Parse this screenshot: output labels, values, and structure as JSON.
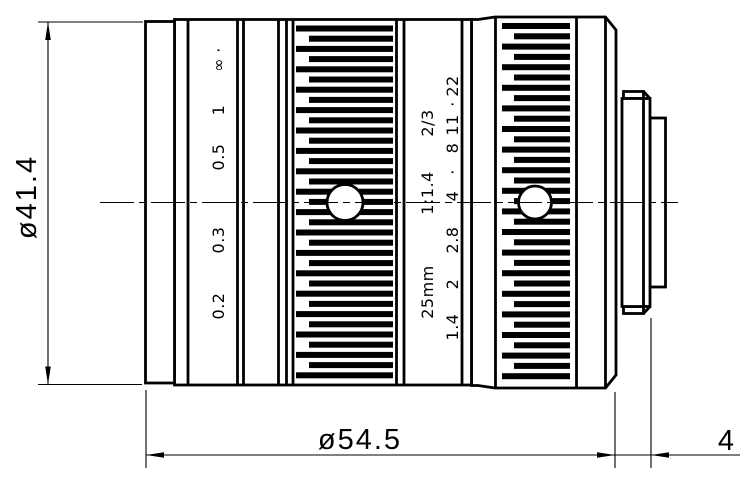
{
  "drawing": {
    "background_color": "#ffffff",
    "line_color": "#000000",
    "dimensions": {
      "height_label": "ø41.4",
      "length_label": "ø54.5",
      "flange_label": "4"
    },
    "focus_ring": {
      "x": 224,
      "labels": [
        {
          "text": "0.2",
          "y": 306
        },
        {
          "text": "0.3",
          "y": 240
        },
        {
          "text": "0.5",
          "y": 157
        },
        {
          "text": "1",
          "y": 110
        },
        {
          "text": "∞",
          "y": 65
        },
        {
          "text": "·",
          "y": 50
        }
      ]
    },
    "aperture_ring": {
      "spec_x": 433,
      "spec_labels": [
        {
          "text": "25mm",
          "y": 292
        },
        {
          "text": "1:1.4",
          "y": 193
        },
        {
          "text": "2/3",
          "y": 123
        }
      ],
      "fstop_x": 458,
      "fstop_labels": [
        {
          "text": "1.4",
          "y": 327
        },
        {
          "text": "2",
          "y": 284
        },
        {
          "text": "2.8",
          "y": 240
        },
        {
          "text": "4",
          "y": 196
        },
        {
          "text": "·",
          "y": 172
        },
        {
          "text": "8",
          "y": 148
        },
        {
          "text": "11",
          "y": 125
        },
        {
          "text": "·",
          "y": 104
        },
        {
          "text": "22",
          "y": 86
        }
      ]
    }
  }
}
